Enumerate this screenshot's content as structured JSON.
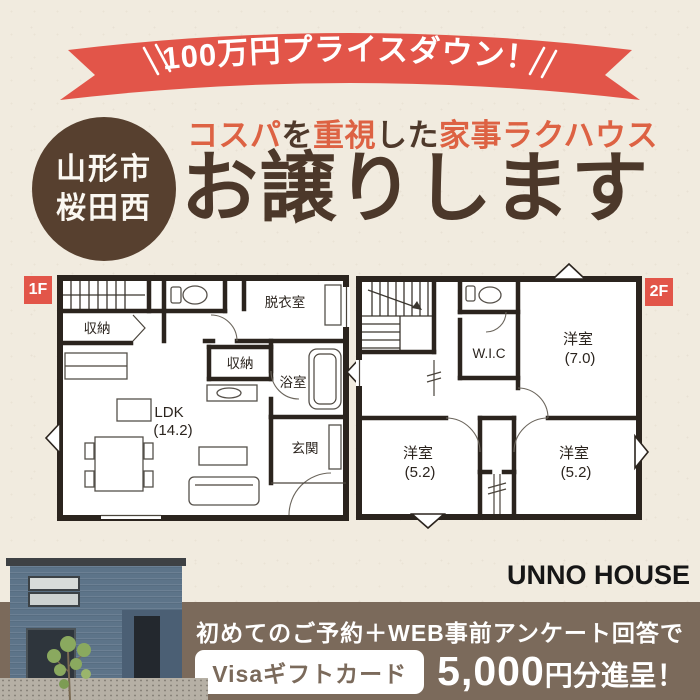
{
  "page": {
    "background_color": "#f1ebdf"
  },
  "ribbon": {
    "label": "100万円プライスダウン！",
    "bg_color": "#e25549",
    "text_color": "#ffffff",
    "decoration": "double-slash-marks"
  },
  "location_badge": {
    "line1": "山形市",
    "line2": "桜田西",
    "bg_color": "#57402f",
    "text_color": "#fbf8f2"
  },
  "headline": {
    "segments": [
      {
        "text": "コスパ",
        "color": "#dd6243"
      },
      {
        "text": "を",
        "color": "#4e392b"
      },
      {
        "text": "重視",
        "color": "#dd6243"
      },
      {
        "text": "した",
        "color": "#4e392b"
      },
      {
        "text": "家事ラクハウス",
        "color": "#dd6243"
      }
    ]
  },
  "title": {
    "text": "お譲りします",
    "color": "#4c382a"
  },
  "floorplan_1f": {
    "label": "1F",
    "label_bg": "#e25549",
    "rooms": {
      "storage1": "収納",
      "dressing_room": "脱衣室",
      "storage2": "収納",
      "bathroom": "浴室",
      "ldk": "LDK",
      "ldk_size": "(14.2)",
      "entrance": "玄関"
    }
  },
  "floorplan_2f": {
    "label": "2F",
    "label_bg": "#e25549",
    "rooms": {
      "wic": "W.I.C",
      "bedroom_a": "洋室",
      "bedroom_a_size": "(7.0)",
      "bedroom_b": "洋室",
      "bedroom_b_size": "(5.2)",
      "bedroom_c": "洋室",
      "bedroom_c_size": "(5.2)"
    }
  },
  "brand": {
    "name": "UNNO HOUSE",
    "color": "#161616"
  },
  "offer_bar": {
    "bg_color": "#7b6a5b",
    "condition": "初めてのご予約＋WEB事前アンケート回答で",
    "badge_label": "Visaギフトカード",
    "amount": "5,000",
    "amount_suffix": "円分進呈！"
  }
}
